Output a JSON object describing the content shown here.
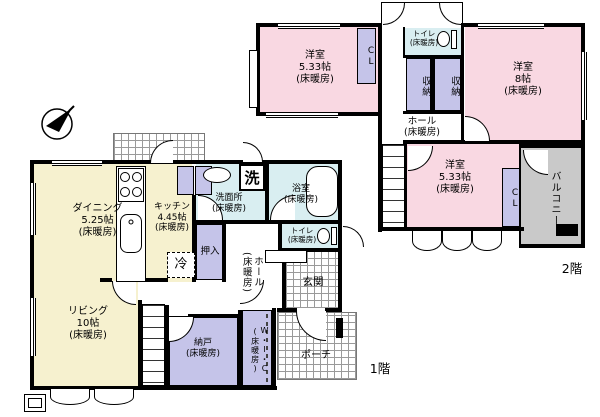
{
  "floor1": {
    "label": "1階",
    "dining": {
      "name": "ダイニング",
      "size": "5.25帖",
      "heating": "(床暖房)"
    },
    "kitchen": {
      "name": "キッチン",
      "size": "4.45帖",
      "heating": "(床暖房)"
    },
    "living": {
      "name": "リビング",
      "size": "10帖",
      "heating": "(床暖房)"
    },
    "washroom": {
      "name": "洗面所",
      "heating": "(床暖房)"
    },
    "washer": {
      "label": "洗"
    },
    "bath": {
      "name": "浴室",
      "heating": "(床暖房)"
    },
    "toilet": {
      "name": "トイレ",
      "heating": "(床暖房)"
    },
    "hall": {
      "name": "ホール",
      "heating": "(床暖房)"
    },
    "genkan": {
      "name": "玄関"
    },
    "oshiire": {
      "label": "押入"
    },
    "fridge": {
      "label": "冷"
    },
    "storeroom": {
      "name": "納戸",
      "heating": "(床暖房)"
    },
    "wic": {
      "name": "W・I・C",
      "heating": "(床暖房)"
    },
    "porch": {
      "name": "ポーチ"
    }
  },
  "floor2": {
    "label": "2階",
    "bedroom_nw": {
      "name": "洋室",
      "size": "5.33帖",
      "heating": "(床暖房)"
    },
    "bedroom_e": {
      "name": "洋室",
      "size": "8帖",
      "heating": "(床暖房)"
    },
    "bedroom_s": {
      "name": "洋室",
      "size": "5.33帖",
      "heating": "(床暖房)"
    },
    "toilet": {
      "name": "トイレ",
      "heating": "(床暖房)"
    },
    "hall": {
      "name": "ホール",
      "heating": "(床暖房)"
    },
    "closet_nw": {
      "label": "CL"
    },
    "closet_s": {
      "label": "CL"
    },
    "storage_left": {
      "label": "収納"
    },
    "storage_right": {
      "label": "収納"
    },
    "balcony": {
      "name": "バルコニー"
    }
  },
  "colors": {
    "room_pink": "#f9d8e2",
    "room_yellow": "#f6f1cf",
    "room_blue": "#d9eef1",
    "room_purple": "#c5c4e9",
    "balcony_gray": "#c9c9c9",
    "wall": "#000000"
  }
}
